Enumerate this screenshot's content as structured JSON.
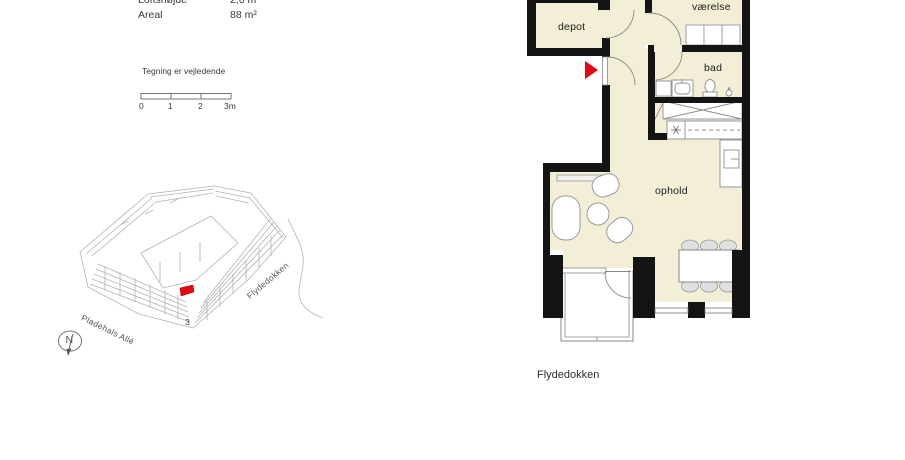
{
  "meta": {
    "rows": [
      {
        "label": "Loftshøjde",
        "value": "2,6 m"
      },
      {
        "label": "Areal",
        "value": "88 m²"
      }
    ],
    "disclaimer": "Tegning er vejledende",
    "scale_ticks": [
      "0",
      "1",
      "2",
      "3m"
    ]
  },
  "site_plan": {
    "street_left": "Pladehals Allé",
    "street_right": "Flydedokken",
    "building_number": "3",
    "north_label": "N",
    "highlight_color": "#e30613"
  },
  "floor_plan": {
    "room_depot": "depot",
    "room_vaerelse": "værelse",
    "room_bad": "bad",
    "room_ophold": "ophold",
    "street_label": "Flydedokken",
    "wall_color": "#141414",
    "floor_color": "#f3eed6",
    "entry_marker_color": "#e30613"
  }
}
